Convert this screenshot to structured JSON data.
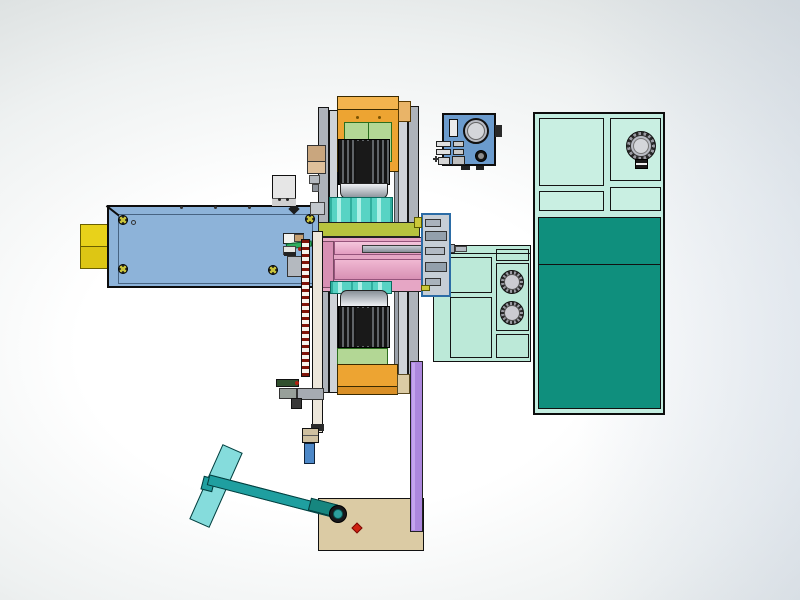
{
  "scene": {
    "type": "cad-assembly-render",
    "description": "Side view of an automated press / dispensing machine assembly rendered in a CAD viewport",
    "visible_text": [],
    "background": {
      "center": "#ffffff",
      "edge": "#d2d7d7"
    }
  },
  "colors": {
    "bgCenter": "#ffffff",
    "bgEdge": "#d2d7d7",
    "yellow": "#e8d21a",
    "steel": "#8db3d9",
    "steelLight": "#a9c7e6",
    "grayLight": "#e6e6e6",
    "grayCol": "#c7cbd1",
    "grayColDark": "#aeb3ba",
    "orange": "#eda432",
    "orangeLight": "#f3b44e",
    "orangeDark": "#d98f26",
    "green": "#b3d795",
    "motorDark": "#141414",
    "motorFin": "#606468",
    "silverHi": "#eef0f4",
    "silverLo": "#889098",
    "tealCyl": "#57d3c4",
    "olive": "#b7c33e",
    "pink": "#e6a6c5",
    "pinkLight": "#f4c6dc",
    "pinkDark": "#d890b4",
    "rodGray": "#a7aeb8",
    "ctrlBlue": "#6b9bcd",
    "dialGray": "#d4d6da",
    "mint": "#bce9d8",
    "mintRight": "#c3ede0",
    "tealDark": "#0f8f7d",
    "purple": "#ac87dd",
    "purpleHi": "#c3a4ee",
    "tan": "#dbcba4",
    "tanDark": "#c9a67e",
    "red": "#cf2212",
    "handleTeal": "#1f9fa0",
    "handleBlade": "#85dcdc",
    "nozzleBlue": "#4d88c8",
    "rackTooth": "#801408",
    "barIvory": "#ece6da",
    "knobGray": "#cbcbd1"
  },
  "components": [
    {
      "name": "linear-slide-actuator",
      "color": "#8db3d9",
      "details": "horizontal slide body with 4 cross-slot screws and cable connector box"
    },
    {
      "name": "yellow-end-block",
      "color": "#e8d21a",
      "details": "two stacked blocks at left end of slide"
    },
    {
      "name": "press-head-assembly",
      "color": "#eda432",
      "details": "vertical stack: orange housing, green gearbox, finned motor, teal cylinders, olive plate, pink spindle block – mirrored top and bottom"
    },
    {
      "name": "center-shaft",
      "color": "#a7aeb8",
      "details": "gray rod through pink spindle block"
    },
    {
      "name": "bearing-end-box",
      "color": "#c6ced6",
      "details": "stepped bearing housing at right end of spindle"
    },
    {
      "name": "feed-rack",
      "color": "#801408",
      "details": "vertical toothed rack hanging below spindle block"
    },
    {
      "name": "dispenser-nozzle",
      "color": "#4d88c8",
      "details": "blue nozzle with tan collar at bottom of guide bar"
    },
    {
      "name": "pendant-control-box",
      "color": "#6b9bcd",
      "details": "blue box with large dial, slot window, connector bank and round knob"
    },
    {
      "name": "center-valve-panel",
      "color": "#bce9d8",
      "knob_count": 2,
      "details": "mint panel with two ridged round valves"
    },
    {
      "name": "right-cabinet-panel",
      "color": "#c3ede0",
      "knob_count": 1,
      "details": "mint cabinet with one ridged valve and dark teal door"
    },
    {
      "name": "cabinet-door-dark",
      "color": "#0f8f7d",
      "details": "dark teal two-section door"
    },
    {
      "name": "support-column",
      "color": "#ac87dd",
      "details": "purple vertical post to base plate"
    },
    {
      "name": "base-plate",
      "color": "#dbcba4",
      "details": "tan plate with red indicator dot and lever pivot"
    },
    {
      "name": "t-handle-lever",
      "color": "#1f9fa0",
      "details": "teal rod with light-teal paddle, hinged on base plate"
    }
  ]
}
